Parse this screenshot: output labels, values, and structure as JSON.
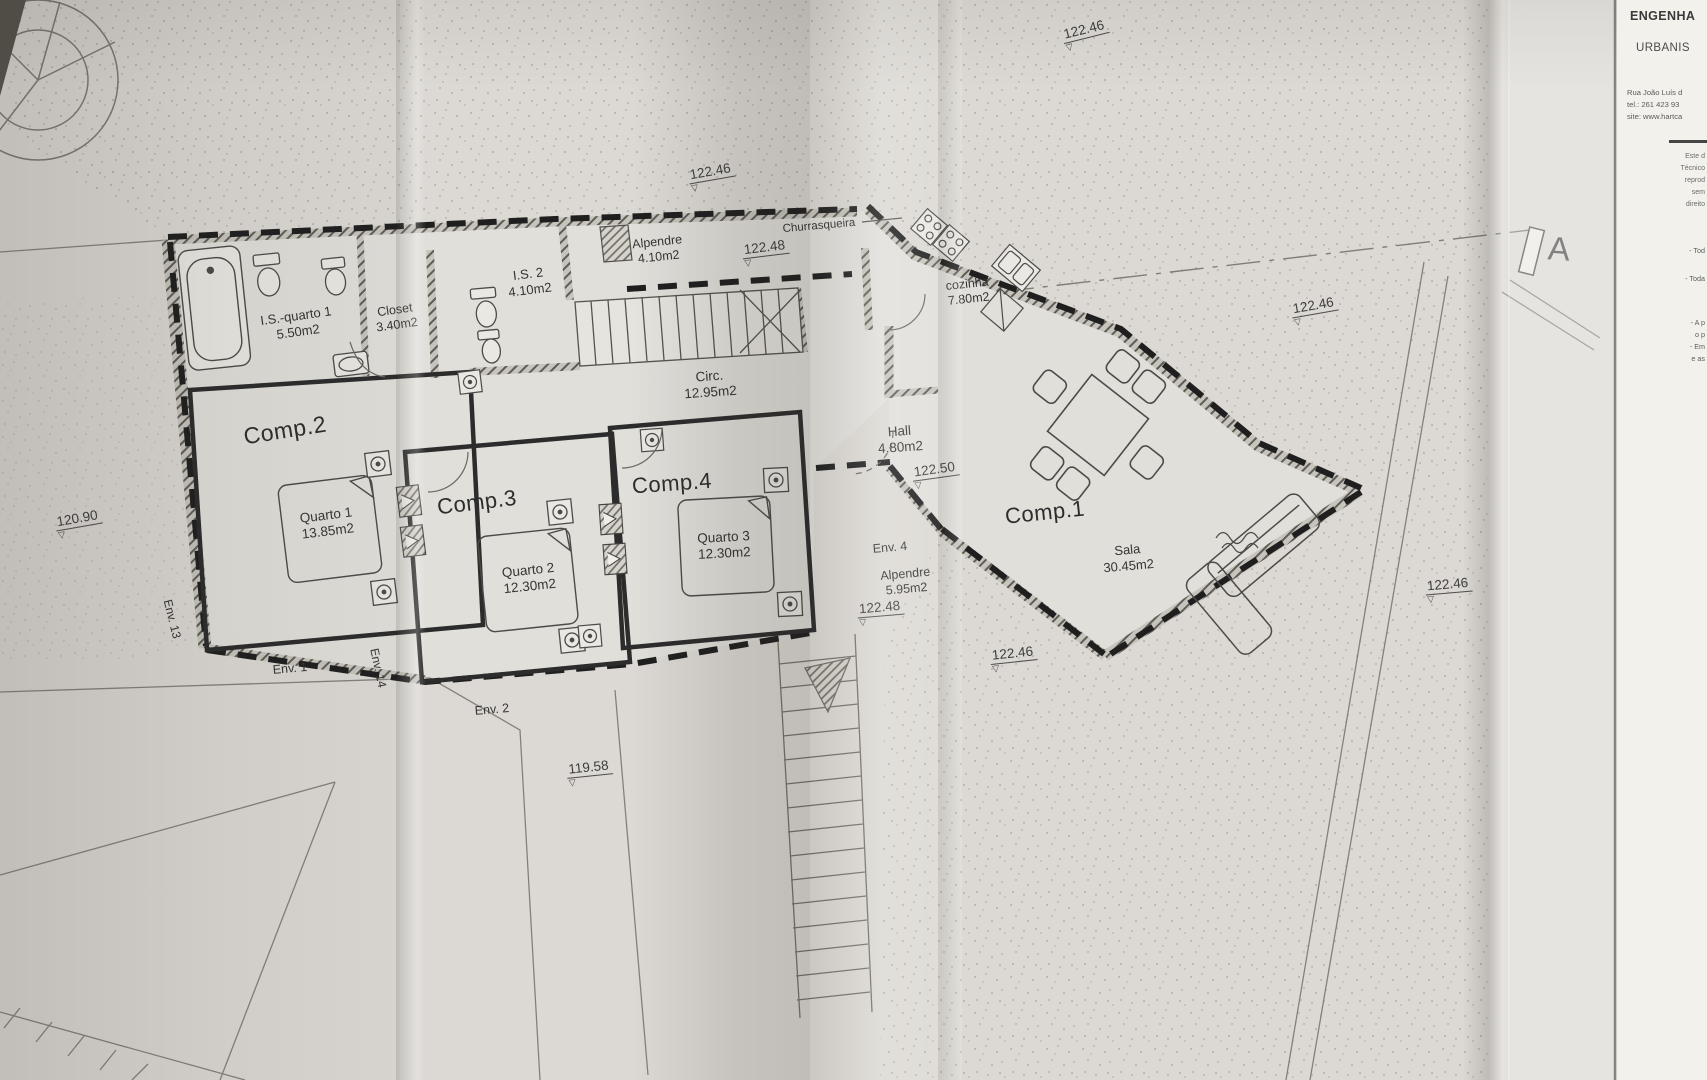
{
  "paper": {
    "bg": "#dcd9d4",
    "ink": "#3c3c3c",
    "dash_ink": "#1f1f1f"
  },
  "symbols": {
    "level_triangle": "▽"
  },
  "section_marker": {
    "label": "A"
  },
  "title_block": {
    "firm_line1": "ENGENHA",
    "firm_line2": "URBANIS",
    "address": "Rua João Luís d",
    "tel": "tel.: 261 423 93",
    "site": "site: www.hartca",
    "disclaimer_lines": [
      "Este d",
      "Técnico",
      "reprod",
      "sem",
      "direito"
    ],
    "note_lines": [
      {
        "text": "- Tod",
        "y": 246
      },
      {
        "text": "- Toda",
        "y": 274
      },
      {
        "text": "- A p",
        "y": 318
      },
      {
        "text": "o p",
        "y": 330
      },
      {
        "text": "- Em",
        "y": 342
      },
      {
        "text": "e as",
        "y": 354
      }
    ]
  },
  "room_labels": [
    {
      "id": "is-quarto-1",
      "lines": [
        "I.S.-quarto 1",
        "5.50m2"
      ],
      "x": 297,
      "y": 324,
      "rot": -8,
      "size": 13
    },
    {
      "id": "closet",
      "lines": [
        "Closet",
        "3.40m2"
      ],
      "x": 396,
      "y": 318,
      "rot": -8,
      "size": 12.5
    },
    {
      "id": "is-2",
      "lines": [
        "I.S. 2",
        "4.10m2"
      ],
      "x": 529,
      "y": 282,
      "rot": -7,
      "size": 13
    },
    {
      "id": "alpendre-norte",
      "lines": [
        "Alpendre",
        "4.10m2"
      ],
      "x": 658,
      "y": 250,
      "rot": -6,
      "size": 12.5
    },
    {
      "id": "churrasqueira",
      "lines": [
        "Churrasqueira"
      ],
      "x": 819,
      "y": 226,
      "rot": -5,
      "size": 11.5
    },
    {
      "id": "cozinha",
      "lines": [
        "cozinha",
        "7.80m2"
      ],
      "x": 968,
      "y": 292,
      "rot": -6,
      "size": 12.5
    },
    {
      "id": "circ",
      "lines": [
        "Circ.",
        "12.95m2"
      ],
      "x": 710,
      "y": 385,
      "rot": -4,
      "size": 13.5
    },
    {
      "id": "hall",
      "lines": [
        "Hall",
        "4.80m2"
      ],
      "x": 900,
      "y": 440,
      "rot": -4,
      "size": 13.5
    },
    {
      "id": "comp-2",
      "lines": [
        "Comp.2"
      ],
      "x": 285,
      "y": 430,
      "rot": -9,
      "size": 23,
      "big": true
    },
    {
      "id": "comp-3",
      "lines": [
        "Comp.3"
      ],
      "x": 477,
      "y": 503,
      "rot": -7,
      "size": 22,
      "big": true
    },
    {
      "id": "comp-4",
      "lines": [
        "Comp.4"
      ],
      "x": 672,
      "y": 484,
      "rot": -4,
      "size": 22,
      "big": true
    },
    {
      "id": "comp-1",
      "lines": [
        "Comp.1"
      ],
      "x": 1045,
      "y": 513,
      "rot": -6,
      "size": 22,
      "big": true
    },
    {
      "id": "quarto-1",
      "lines": [
        "Quarto 1",
        "13.85m2"
      ],
      "x": 327,
      "y": 524,
      "rot": -7,
      "size": 13.5
    },
    {
      "id": "quarto-2",
      "lines": [
        "Quarto 2",
        "12.30m2"
      ],
      "x": 529,
      "y": 579,
      "rot": -6,
      "size": 13.5
    },
    {
      "id": "quarto-3",
      "lines": [
        "Quarto 3",
        "12.30m2"
      ],
      "x": 724,
      "y": 546,
      "rot": -3,
      "size": 13.5
    },
    {
      "id": "env-4",
      "lines": [
        "Env. 4"
      ],
      "x": 890,
      "y": 548,
      "rot": -5,
      "size": 12.5
    },
    {
      "id": "alpendre-sul",
      "lines": [
        "Alpendre",
        "5.95m2"
      ],
      "x": 906,
      "y": 582,
      "rot": -5,
      "size": 12.5
    },
    {
      "id": "sala",
      "lines": [
        "Sala",
        "30.45m2"
      ],
      "x": 1128,
      "y": 558,
      "rot": -5,
      "size": 13
    },
    {
      "id": "env-1",
      "lines": [
        "Env. 1"
      ],
      "x": 290,
      "y": 669,
      "rot": -5,
      "size": 12.5
    },
    {
      "id": "env-2",
      "lines": [
        "Env. 2"
      ],
      "x": 492,
      "y": 710,
      "rot": -5,
      "size": 12.5
    },
    {
      "id": "env-13",
      "lines": [
        "Env. 13"
      ],
      "x": 172,
      "y": 619,
      "rot": 76,
      "size": 12
    },
    {
      "id": "env-14",
      "lines": [
        "Env. 14"
      ],
      "x": 378,
      "y": 668,
      "rot": 78,
      "size": 12
    }
  ],
  "level_markers": [
    {
      "value": "122.46",
      "x": 1086,
      "y": 34,
      "rot": -14
    },
    {
      "value": "122.46",
      "x": 712,
      "y": 176,
      "rot": -10
    },
    {
      "value": "122.48",
      "x": 766,
      "y": 252,
      "rot": -7
    },
    {
      "value": "122.46",
      "x": 1315,
      "y": 310,
      "rot": -10
    },
    {
      "value": "122.50",
      "x": 936,
      "y": 474,
      "rot": -8
    },
    {
      "value": "122.48",
      "x": 881,
      "y": 612,
      "rot": -5
    },
    {
      "value": "122.46",
      "x": 1449,
      "y": 589,
      "rot": -5
    },
    {
      "value": "122.46",
      "x": 1014,
      "y": 658,
      "rot": -6
    },
    {
      "value": "120.90",
      "x": 79,
      "y": 523,
      "rot": -10
    },
    {
      "value": "119.58",
      "x": 590,
      "y": 772,
      "rot": -6
    }
  ]
}
